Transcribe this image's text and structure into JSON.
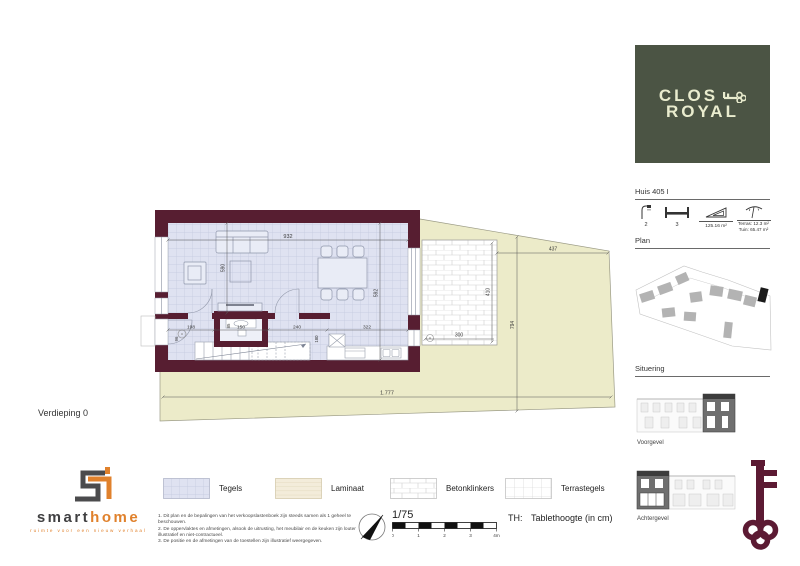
{
  "page": {
    "floor_label": "Verdieping 0"
  },
  "brand_box": {
    "line1": "CLOS",
    "line2": "ROYAL"
  },
  "unit": {
    "title": "Huis 405 I",
    "showers": "2",
    "bedrooms": "3",
    "area": "125.16 m²",
    "terras_label": "Terras:",
    "terras_value": "12.3 m²",
    "tuin_label": "Tuin:",
    "tuin_value": "65.47 m²"
  },
  "sections": {
    "plan": "Plan",
    "situering": "Situering",
    "voorgevel": "Voorgevel",
    "achtergevel": "Achtergevel"
  },
  "dims": {
    "top_width": "932",
    "left_height": "590",
    "right_height": "592",
    "hall_width": "198",
    "wc_width": "150",
    "stairs_width": "240",
    "kitchen_width": "322",
    "hall_depth": "96",
    "wc_door": "85",
    "stairs_depth": "180",
    "terrace_width": "300",
    "terrace_depth": "410",
    "garden_width": "437",
    "garden_depth": "794",
    "site_width": "1.777"
  },
  "legend": {
    "items": [
      {
        "label": "Tegels",
        "pattern": "tiles"
      },
      {
        "label": "Laminaat",
        "pattern": "laminate"
      },
      {
        "label": "Betonklinkers",
        "pattern": "brick"
      },
      {
        "label": "Terrastegels",
        "pattern": "terrace-grid"
      }
    ]
  },
  "notes": {
    "n1": "1. Dit plan en de bepalingen van het verkoopslastenboek zijn steeds samen als 1 geheel te beschouwen.",
    "n2": "2. De oppervlaktes en afmetingen, alsook de uitrusting, het meubilair en de keuken zijn louter illustratief en niet-contractueel.",
    "n3": "3. De positie en de afmetingen van de toestellen zijn illustratief weergegeven."
  },
  "scale": {
    "ratio": "1/75",
    "t0": "0",
    "t1": "1",
    "t2": "2",
    "t3": "3",
    "t4": "4m",
    "th_label": "TH:",
    "th_text": "Tablethoogte (in cm)"
  },
  "logo": {
    "smart": "smart",
    "home": "home",
    "tagline": "ruimte voor een nieuw verhaal"
  },
  "colors": {
    "wall": "#571e31",
    "floor_tile": "#dfe2f1",
    "garden": "#ecebc9",
    "brand_green": "#4b5444",
    "brand_cream": "#e9ecce",
    "orange": "#e0812c",
    "key_maroon": "#5c1a33"
  }
}
